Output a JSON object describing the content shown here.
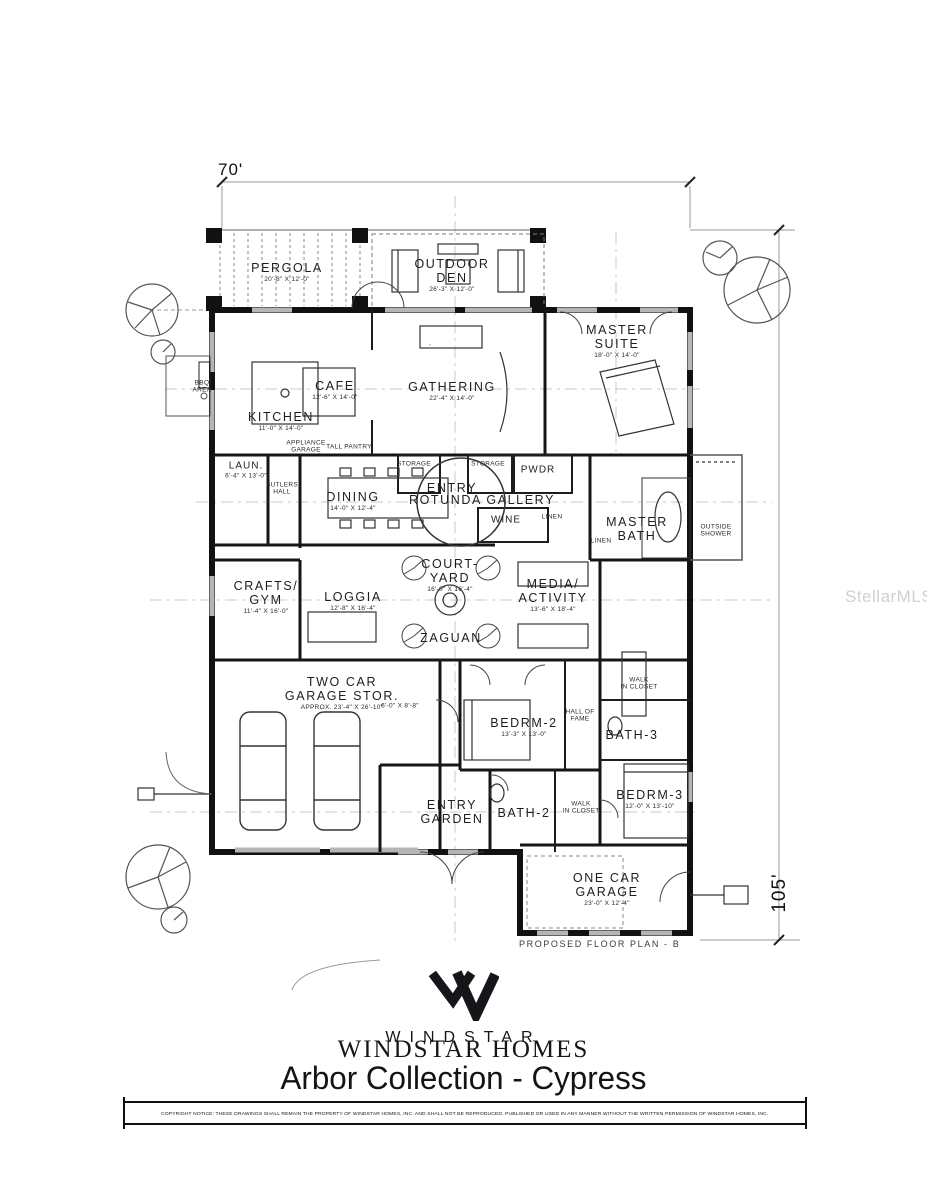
{
  "dims": {
    "width_label": "70'",
    "height_label": "105'"
  },
  "plan": {
    "caption": "PROPOSED FLOOR PLAN - B",
    "rooms": [
      {
        "lines": [
          "PERGOLA"
        ],
        "dim": "20'-8\" X 12'-0\"",
        "x": 287,
        "y": 272,
        "size": "lg"
      },
      {
        "lines": [
          "OUTDOOR",
          "DEN"
        ],
        "dim": "26'-3\" X 12'-0\"",
        "x": 452,
        "y": 275,
        "size": "lg"
      },
      {
        "lines": [
          "MASTER",
          "SUITE"
        ],
        "dim": "18'-0\" X 14'-0\"",
        "x": 617,
        "y": 341,
        "size": "lg"
      },
      {
        "lines": [
          "CAFE"
        ],
        "dim": "12'-6\" X 14'-0\"",
        "x": 335,
        "y": 390,
        "size": "lg"
      },
      {
        "lines": [
          "KITCHEN"
        ],
        "dim": "11'-0\" X 14'-0\"",
        "x": 281,
        "y": 421,
        "size": "lg"
      },
      {
        "lines": [
          "GATHERING"
        ],
        "dim": "22'-4\" X 14'-0\"",
        "x": 452,
        "y": 391,
        "size": "lg"
      },
      {
        "lines": [
          "BBQ",
          "AREA"
        ],
        "x": 202,
        "y": 387,
        "size": "xs"
      },
      {
        "lines": [
          "APPLIANCE",
          "GARAGE"
        ],
        "x": 306,
        "y": 447,
        "size": "xs"
      },
      {
        "lines": [
          "TALL PANTRY"
        ],
        "x": 349,
        "y": 447,
        "size": "xs"
      },
      {
        "lines": [
          "LAUN."
        ],
        "dim": "6'-4\" X 13'-0\"",
        "x": 246,
        "y": 470,
        "size": "md"
      },
      {
        "lines": [
          "BUTLERS",
          "HALL"
        ],
        "x": 282,
        "y": 489,
        "size": "xs"
      },
      {
        "lines": [
          "DINING"
        ],
        "dim": "14'-0\" X 12'-4\"",
        "x": 353,
        "y": 501,
        "size": "lg"
      },
      {
        "lines": [
          "STORAGE"
        ],
        "x": 414,
        "y": 464,
        "size": "xs"
      },
      {
        "lines": [
          "STORAGE"
        ],
        "x": 488,
        "y": 464,
        "size": "xs"
      },
      {
        "lines": [
          "ENTRY"
        ],
        "x": 452,
        "y": 488,
        "size": "lg"
      },
      {
        "lines": [
          "ROTUNDA GALLERY"
        ],
        "x": 482,
        "y": 500,
        "size": "lg"
      },
      {
        "lines": [
          "PWDR"
        ],
        "x": 538,
        "y": 470,
        "size": "md"
      },
      {
        "lines": [
          "WINE"
        ],
        "x": 506,
        "y": 520,
        "size": "md"
      },
      {
        "lines": [
          "LINEN"
        ],
        "x": 552,
        "y": 517,
        "size": "xs"
      },
      {
        "lines": [
          "MASTER",
          "BATH"
        ],
        "x": 637,
        "y": 529,
        "size": "lg"
      },
      {
        "lines": [
          "LINEN"
        ],
        "x": 601,
        "y": 541,
        "size": "xs"
      },
      {
        "lines": [
          "OUTSIDE",
          "SHOWER"
        ],
        "x": 716,
        "y": 531,
        "size": "xs"
      },
      {
        "lines": [
          "CRAFTS/",
          "GYM"
        ],
        "dim": "11'-4\" X 16'-0\"",
        "x": 266,
        "y": 597,
        "size": "lg"
      },
      {
        "lines": [
          "LOGGIA"
        ],
        "dim": "12'-8\" X 16'-4\"",
        "x": 353,
        "y": 601,
        "size": "lg"
      },
      {
        "lines": [
          "COURT-",
          "YARD"
        ],
        "dim": "16'-0\" X 16'-4\"",
        "x": 450,
        "y": 575,
        "size": "lg"
      },
      {
        "lines": [
          "MEDIA/",
          "ACTIVITY"
        ],
        "dim": "13'-6\" X 18'-4\"",
        "x": 553,
        "y": 595,
        "size": "lg"
      },
      {
        "lines": [
          "ZAGUAN"
        ],
        "x": 451,
        "y": 638,
        "size": "lg"
      },
      {
        "lines": [
          "TWO CAR",
          "GARAGE STOR."
        ],
        "dim": "APPROX. 23'-4\" X 26'-10\"",
        "x": 342,
        "y": 693,
        "size": "lg"
      },
      {
        "lines": [
          "6'-0\" X 8'-8\""
        ],
        "x": 400,
        "y": 706,
        "size": "xs"
      },
      {
        "lines": [
          "WALK",
          "IN CLOSET"
        ],
        "x": 639,
        "y": 684,
        "size": "xs"
      },
      {
        "lines": [
          "BEDRM-2"
        ],
        "dim": "13'-3\" X 13'-0\"",
        "x": 524,
        "y": 727,
        "size": "lg"
      },
      {
        "lines": [
          "HALL OF",
          "FAME"
        ],
        "x": 580,
        "y": 716,
        "size": "xs"
      },
      {
        "lines": [
          "BATH-3"
        ],
        "x": 632,
        "y": 735,
        "size": "lg"
      },
      {
        "lines": [
          "ENTRY",
          "GARDEN"
        ],
        "x": 452,
        "y": 812,
        "size": "lg"
      },
      {
        "lines": [
          "BATH-2"
        ],
        "x": 524,
        "y": 813,
        "size": "lg"
      },
      {
        "lines": [
          "WALK",
          "IN CLOSET"
        ],
        "x": 581,
        "y": 808,
        "size": "xs"
      },
      {
        "lines": [
          "BEDRM-3"
        ],
        "dim": "12'-0\" X 13'-10\"",
        "x": 650,
        "y": 799,
        "size": "lg"
      },
      {
        "lines": [
          "ONE CAR",
          "GARAGE"
        ],
        "dim": "23'-0\" X 12'-4\"",
        "x": 607,
        "y": 889,
        "size": "lg"
      }
    ]
  },
  "branding": {
    "logo_sans": "WINDSTAR",
    "logo_serif": "WINDSTAR HOMES",
    "title": "Arbor Collection - Cypress"
  },
  "watermark": {
    "text": "StellarMLS"
  },
  "footer": {
    "copyright": "COPYRIGHT NOTICE:  THESE DRAWINGS SHALL REMAIN THE PROPERTY OF WINDSTAR HOMES, INC. AND SHALL NOT BE REPRODUCED, PUBLISHED OR USED IN ANY MANNER WITHOUT THE WRITTEN PERMISSION OF WINDSTAR HOMES, INC."
  },
  "colors": {
    "ink": "#141414",
    "line_gray": "#9a9a9a",
    "centerline": "#c8c8c8",
    "window": "#b5b5b5"
  }
}
